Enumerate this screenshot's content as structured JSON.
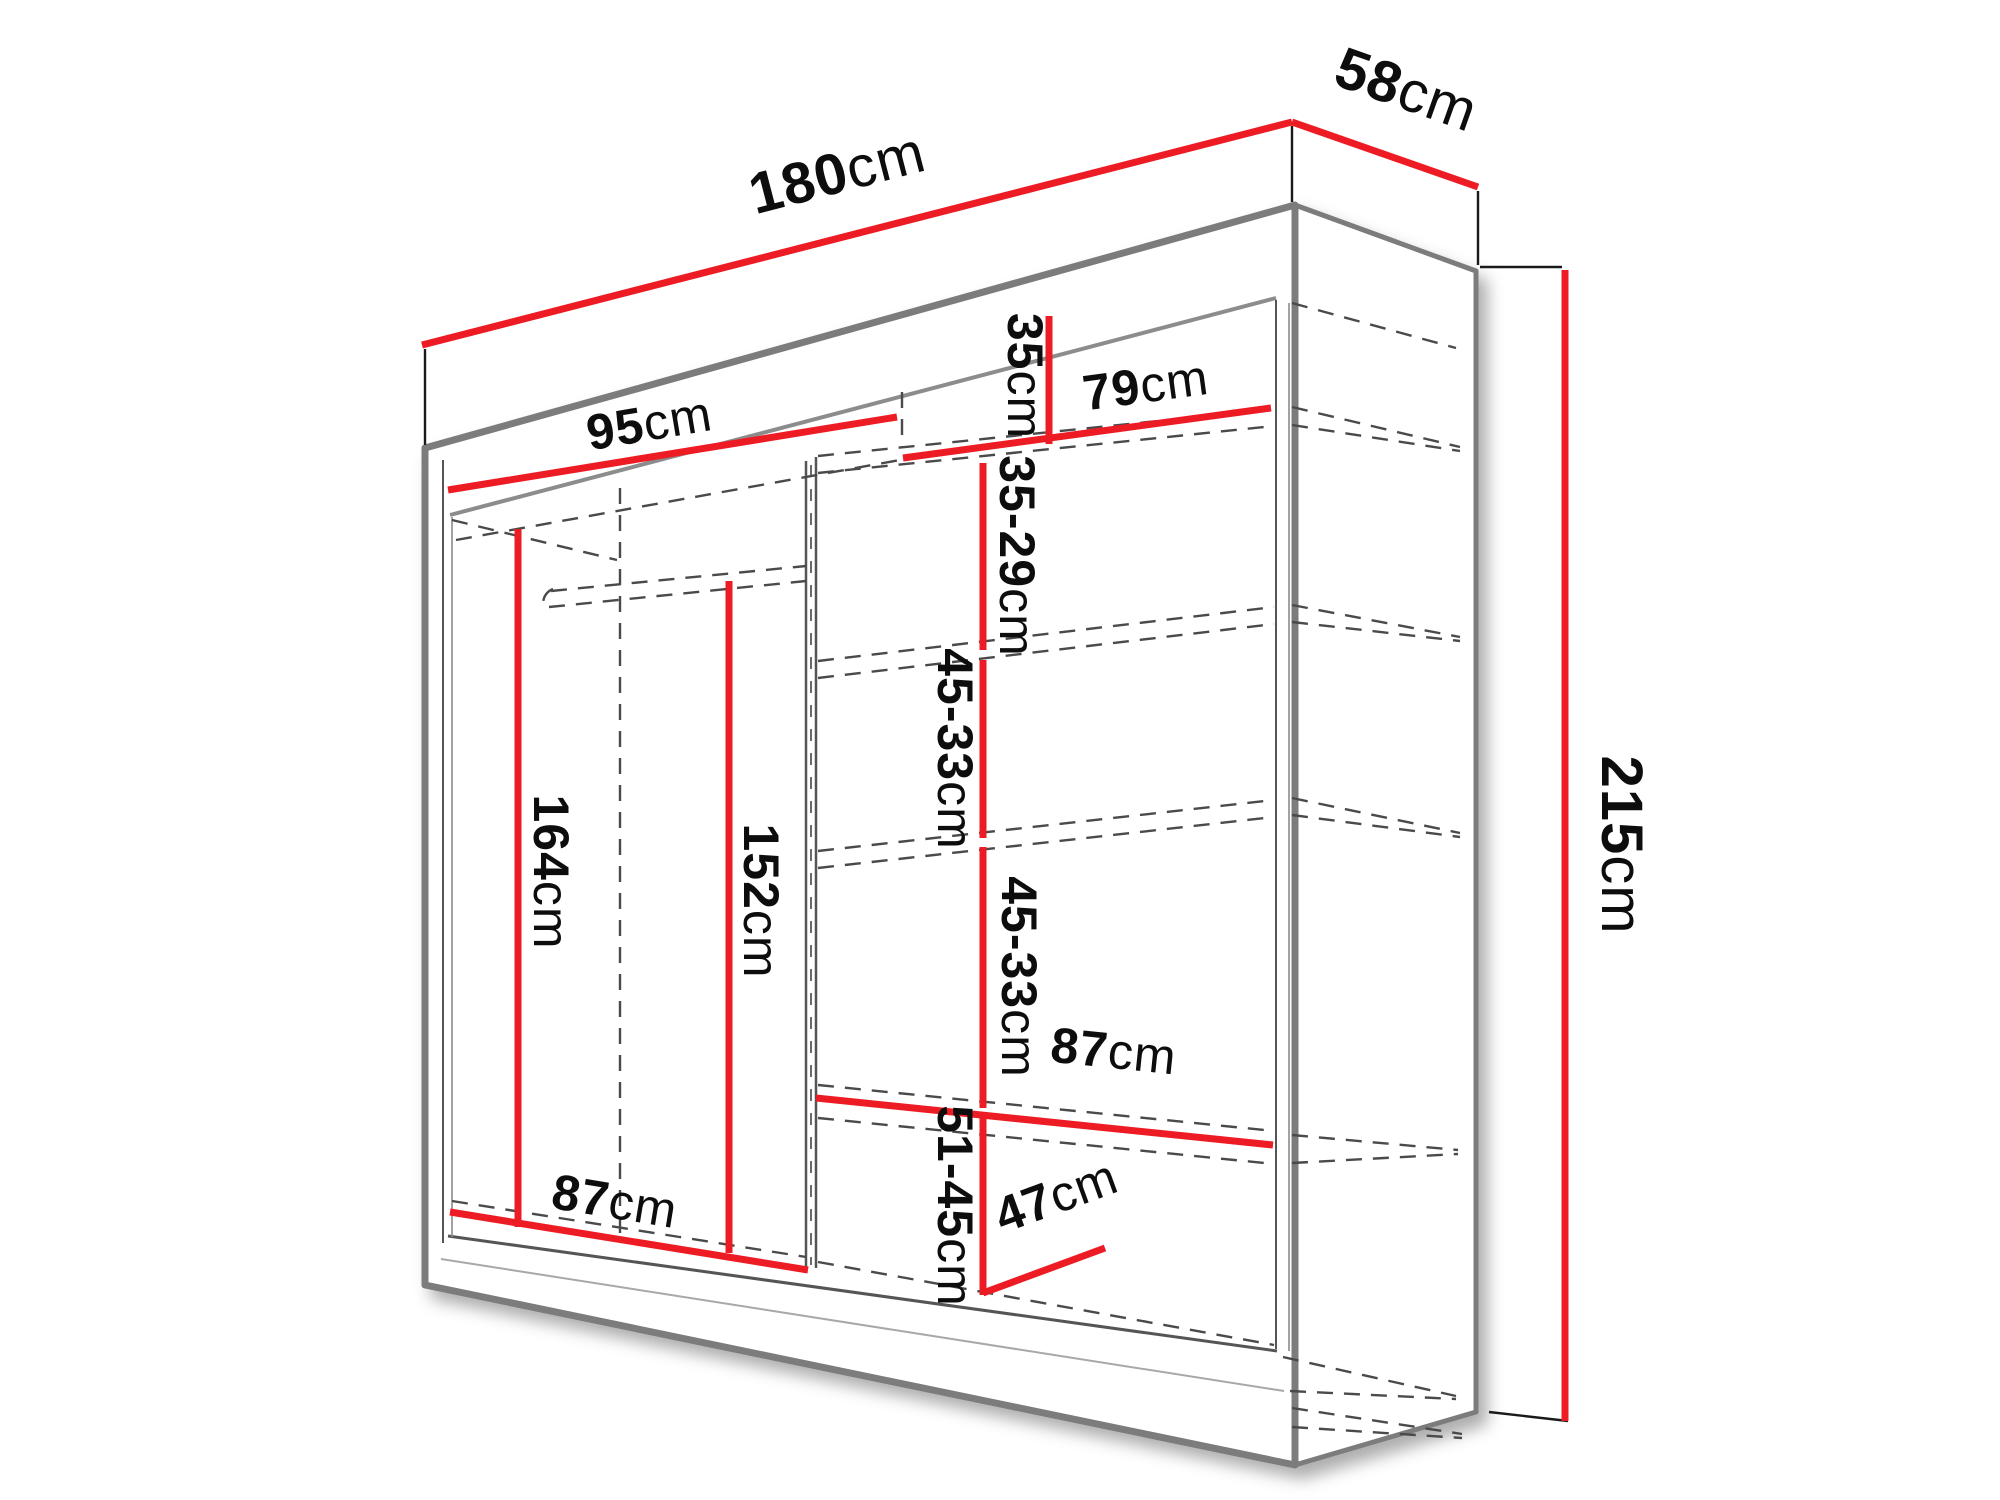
{
  "diagram": {
    "title": "Sliding wardrobe dimension diagram",
    "type": "furniture-dimension-drawing",
    "unit": "cm",
    "colors": {
      "dimension_line": "#ed1c24",
      "cabinet_outline": "#7b7b7b",
      "guide_dashed": "#4a4a4a",
      "label_text": "#0d0d0d",
      "background": "#ffffff"
    },
    "labels": {
      "w180": {
        "value": "180",
        "unit": "cm"
      },
      "d58": {
        "value": "58",
        "unit": "cm"
      },
      "h215": {
        "value": "215",
        "unit": "cm"
      },
      "w95": {
        "value": "95",
        "unit": "cm"
      },
      "w79": {
        "value": "79",
        "unit": "cm"
      },
      "h35": {
        "value": "35",
        "unit": "cm"
      },
      "g35_29": {
        "value": "35-29",
        "unit": "cm"
      },
      "g45_33a": {
        "value": "45-33",
        "unit": "cm"
      },
      "g45_33b": {
        "value": "45-33",
        "unit": "cm"
      },
      "h164": {
        "value": "164",
        "unit": "cm"
      },
      "h152": {
        "value": "152",
        "unit": "cm"
      },
      "w87_left": {
        "value": "87",
        "unit": "cm"
      },
      "w87_right": {
        "value": "87",
        "unit": "cm"
      },
      "g51_45": {
        "value": "51-45",
        "unit": "cm"
      },
      "d47": {
        "value": "47",
        "unit": "cm"
      }
    }
  }
}
